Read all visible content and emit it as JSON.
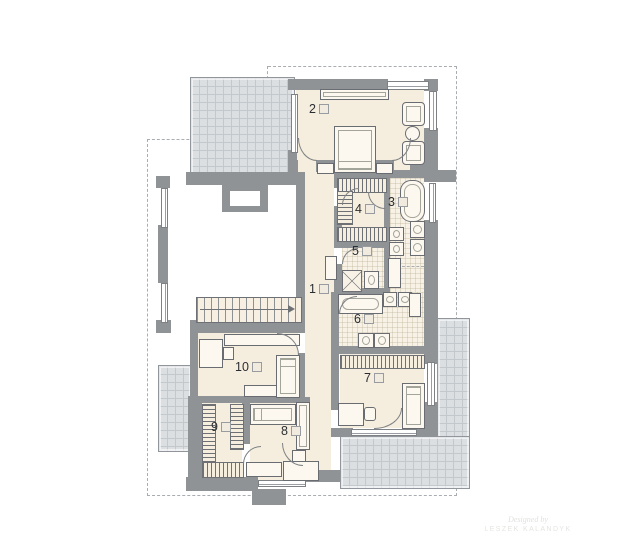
{
  "plan": {
    "room_labels": [
      {
        "num": "1"
      },
      {
        "num": "2"
      },
      {
        "num": "3"
      },
      {
        "num": "4"
      },
      {
        "num": "5"
      },
      {
        "num": "6"
      },
      {
        "num": "7"
      },
      {
        "num": "8"
      },
      {
        "num": "9"
      },
      {
        "num": "10"
      }
    ],
    "signature": {
      "line1": "Designed by",
      "line2": "LESZEK KALANDYK"
    },
    "colors": {
      "wall": "#8f9396",
      "floor": "#f5eddd",
      "tile_floor": "#f8f2e6",
      "terrace": "#dcdfe2",
      "open_void": "#ffffff",
      "line": "#6a6e72",
      "dashed_roof": "#a9adb1",
      "label_text": "#2b2e31"
    }
  }
}
